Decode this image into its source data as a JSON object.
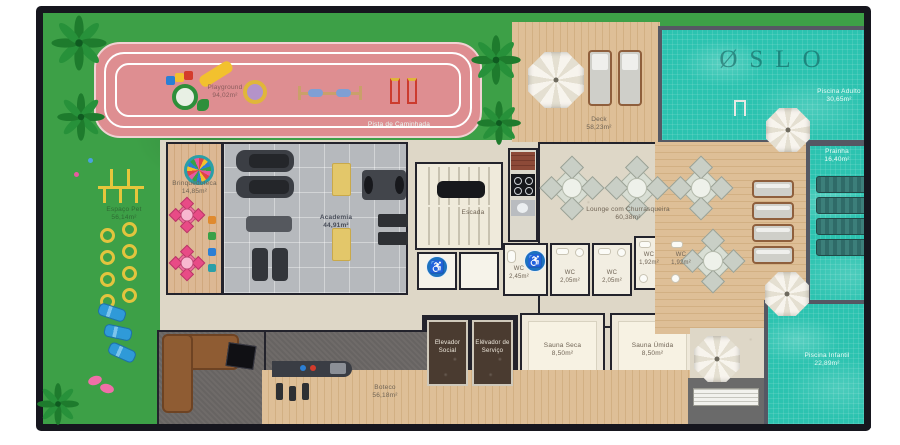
{
  "brand": {
    "logo": "ØSLO"
  },
  "colors": {
    "water": "#2cc3b0",
    "lawn": "#3da047",
    "track": "#de8e91",
    "wood": "#debf97",
    "accessible_blue": "#1d72bf",
    "wall": "#23232c"
  },
  "areas": {
    "playground": {
      "name": "Playground",
      "area": "94,02m²"
    },
    "pista": {
      "name": "Pista de Caminhada"
    },
    "espaco_pet": {
      "name": "Espaço Pet",
      "area": "56,14m²"
    },
    "brinquedoteca": {
      "name": "Brinquedoteca",
      "area": "14,85m²"
    },
    "academia": {
      "name": "Academia",
      "area": "44,91m²"
    },
    "escada": {
      "name": "Escada"
    },
    "deck": {
      "name": "Deck",
      "area": "58,23m²"
    },
    "piscina_adulto": {
      "name": "Piscina Adulto",
      "area": "30,65m²"
    },
    "prainha": {
      "name": "Prainha",
      "area": "16,40m²"
    },
    "lounge": {
      "name": "Lounge com Churrasqueira",
      "area": "60,38m²"
    },
    "wc_pcd": {
      "name": "WC",
      "area": "2,45m²"
    },
    "wc_a": {
      "name": "WC",
      "area": "2,05m²"
    },
    "wc_b": {
      "name": "WC",
      "area": "2,05m²"
    },
    "wc_c": {
      "name": "WC",
      "area": "1,92m²"
    },
    "wc_d": {
      "name": "WC",
      "area": "1,92m²"
    },
    "elevador_social": {
      "line1": "Elevador",
      "line2": "Social"
    },
    "elevador_servico": {
      "line1": "Elevador de",
      "line2": "Serviço"
    },
    "sauna_seca": {
      "name": "Sauna Seca",
      "area": "8,50m²"
    },
    "sauna_umida": {
      "name": "Sauna Úmida",
      "area": "8,50m²"
    },
    "boteco": {
      "name": "Boteco",
      "area": "56,18m²"
    },
    "piscina_infantil": {
      "name": "Piscina Infantil",
      "area": "22,89m²"
    }
  }
}
